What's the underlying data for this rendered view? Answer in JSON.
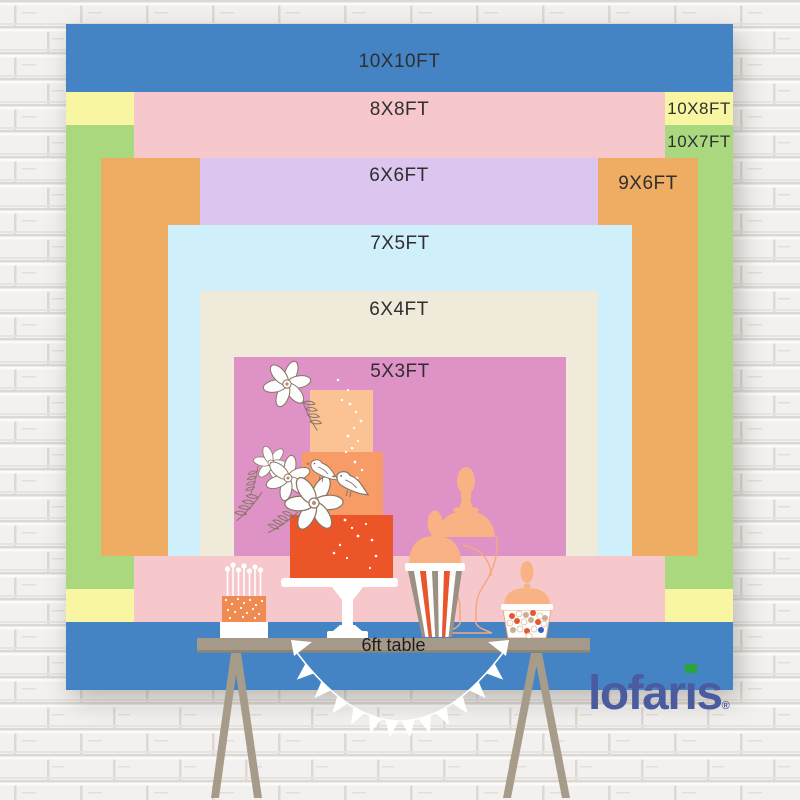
{
  "backdrop": {
    "sizes": [
      {
        "label": "10X10FT",
        "color": "#4484C5"
      },
      {
        "label": "10X8FT",
        "color": "#F9F6A3"
      },
      {
        "label": "10X7FT",
        "color": "#A9D87F"
      },
      {
        "label": "8X8FT",
        "color": "#F6C8CB"
      },
      {
        "label": "9X6FT",
        "color": "#EFAC63"
      },
      {
        "label": "6X6FT",
        "color": "#DCC6EF"
      },
      {
        "label": "7X5FT",
        "color": "#CFEFFA"
      },
      {
        "label": "6X4FT",
        "color": "#F0EADA"
      },
      {
        "label": "5X3FT",
        "color": "#DE92C6"
      }
    ]
  },
  "table": {
    "label": "6ft table",
    "surface_color": "#A5998A"
  },
  "logo": {
    "text": "lofaris",
    "text_before_i": "lofar",
    "i_glyph": "ı",
    "text_after_i": "s",
    "registered": "®",
    "text_color": "#4A5C9F",
    "i_dot_color": "#2CA43C"
  }
}
